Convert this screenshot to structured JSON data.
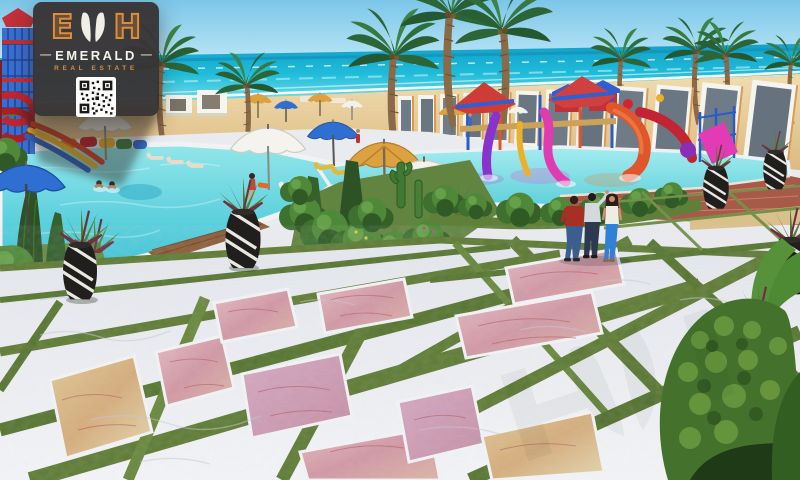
{
  "logo": {
    "monogram": "EDH",
    "monogram_letters": [
      "E",
      "D",
      "H"
    ],
    "brand_name": "EMERALD",
    "brand_subtitle": "REAL ESTATE",
    "dash": "—",
    "qr_label": "qr-code",
    "colors": {
      "card_background": "#3a3839",
      "accent_orange": "#de8c36",
      "text_white": "#f4f1ea"
    }
  },
  "scene": {
    "type": "architectural-render",
    "setting": "Beachfront aqua-park resort: main swimming pool with water-slide tower, kids water playground, white frame wall along the beach, palm trees, marble promenade with grass joints and stone inlay panels",
    "elements": [
      "sky",
      "sea",
      "beach-sand",
      "white-frame-wall",
      "palm-trees",
      "water-slide-tower",
      "main-pool",
      "swimmers",
      "kids-aqua-park",
      "brick-pool-wall",
      "beach-umbrellas",
      "beach-cabanas",
      "sun-loungers",
      "striped-planter-vases",
      "topiary-bushes",
      "cacti",
      "lawn",
      "wood-deck",
      "marble-plaza",
      "grass-joints",
      "stone-inlay-panels",
      "pedestrians",
      "garden-hedge"
    ],
    "people": {
      "pool_swimmers": 2,
      "pool_edge_sitter": 1,
      "walkway_group": [
        {
          "outfit": "dark red shirt, blue jeans"
        },
        {
          "outfit": "light grey shirt, dark trousers, raised arm"
        },
        {
          "outfit": "white top, bright blue jeans, long dark hair"
        }
      ]
    },
    "palette": {
      "sky": "#8fd2ee",
      "sea": "#1db4d6",
      "sand": "#e6c993",
      "pool_water": "#58d2de",
      "kids_pool": "#8ce2e8",
      "marble_white": "#eceef3",
      "grass_joint": "#5d7a33",
      "lawn": "#678a3e",
      "inlay_pink": "#d9a3ac",
      "inlay_gold": "#d9bd8a",
      "brick_wall": "#a85a49",
      "wood_deck": "#8a5c38",
      "umbrella_blue": "#2f6fd2",
      "umbrella_straw": "#dca242",
      "slide_purple": "#8833cc",
      "slide_magenta": "#e03bb0",
      "slide_orange": "#e0562a",
      "slide_red": "#c22433",
      "tower_blue": "#3a6fd0"
    }
  }
}
